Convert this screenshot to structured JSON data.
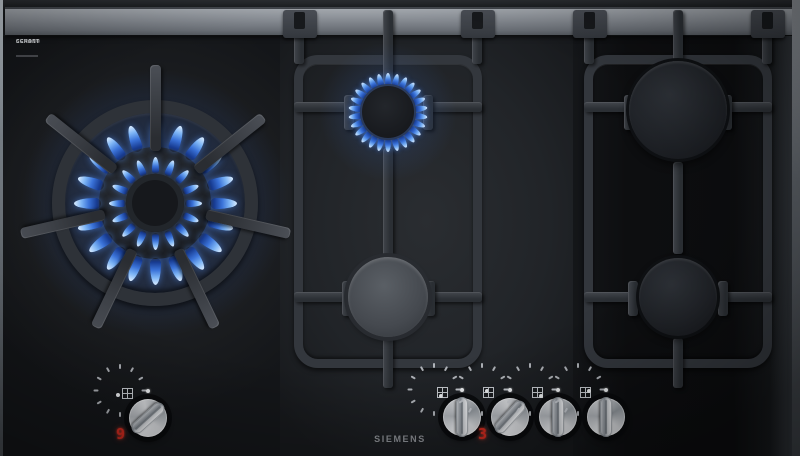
{
  "appliance": {
    "brand": "SIEMENS",
    "glass_badge": {
      "line1": "SCHOTT",
      "line2": "CERAN®"
    },
    "type_description": "5-burner black glass gas hob with cast iron pan supports"
  },
  "burners": [
    {
      "id": "wok",
      "name": "wok-burner",
      "state": "lit",
      "flame_rings": 2
    },
    {
      "id": "center-rear",
      "name": "center-rear-burner",
      "state": "lit",
      "flame_rings": 1
    },
    {
      "id": "center-front",
      "name": "center-front-burner",
      "state": "off",
      "flame_rings": 0
    },
    {
      "id": "right-rear",
      "name": "right-rear-burner",
      "state": "off",
      "flame_rings": 0
    },
    {
      "id": "right-front",
      "name": "right-front-burner",
      "state": "off",
      "flame_rings": 0
    }
  ],
  "controls": {
    "knobs": [
      {
        "id": "wok",
        "burner": "wok",
        "display": "9",
        "angle_deg": 138,
        "icon_dot": "outside-left"
      },
      {
        "id": "center-front",
        "burner": "center-front",
        "display": "",
        "angle_deg": 90,
        "icon_dot": "bottom-left"
      },
      {
        "id": "center-rear",
        "burner": "center-rear",
        "display": "3",
        "angle_deg": 132,
        "icon_dot": "top-left"
      },
      {
        "id": "right-front",
        "burner": "right-front",
        "display": "",
        "angle_deg": 90,
        "icon_dot": "bottom-right"
      },
      {
        "id": "right-rear",
        "burner": "right-rear",
        "display": "",
        "angle_deg": 90,
        "icon_dot": "top-right"
      }
    ]
  },
  "colors": {
    "flame_blue": "#4d8fe8",
    "display_red": "#cf2a1f",
    "metal_trim": "#84898f",
    "knob_silver": "#c9ccd1",
    "glass_black": "#141619"
  }
}
